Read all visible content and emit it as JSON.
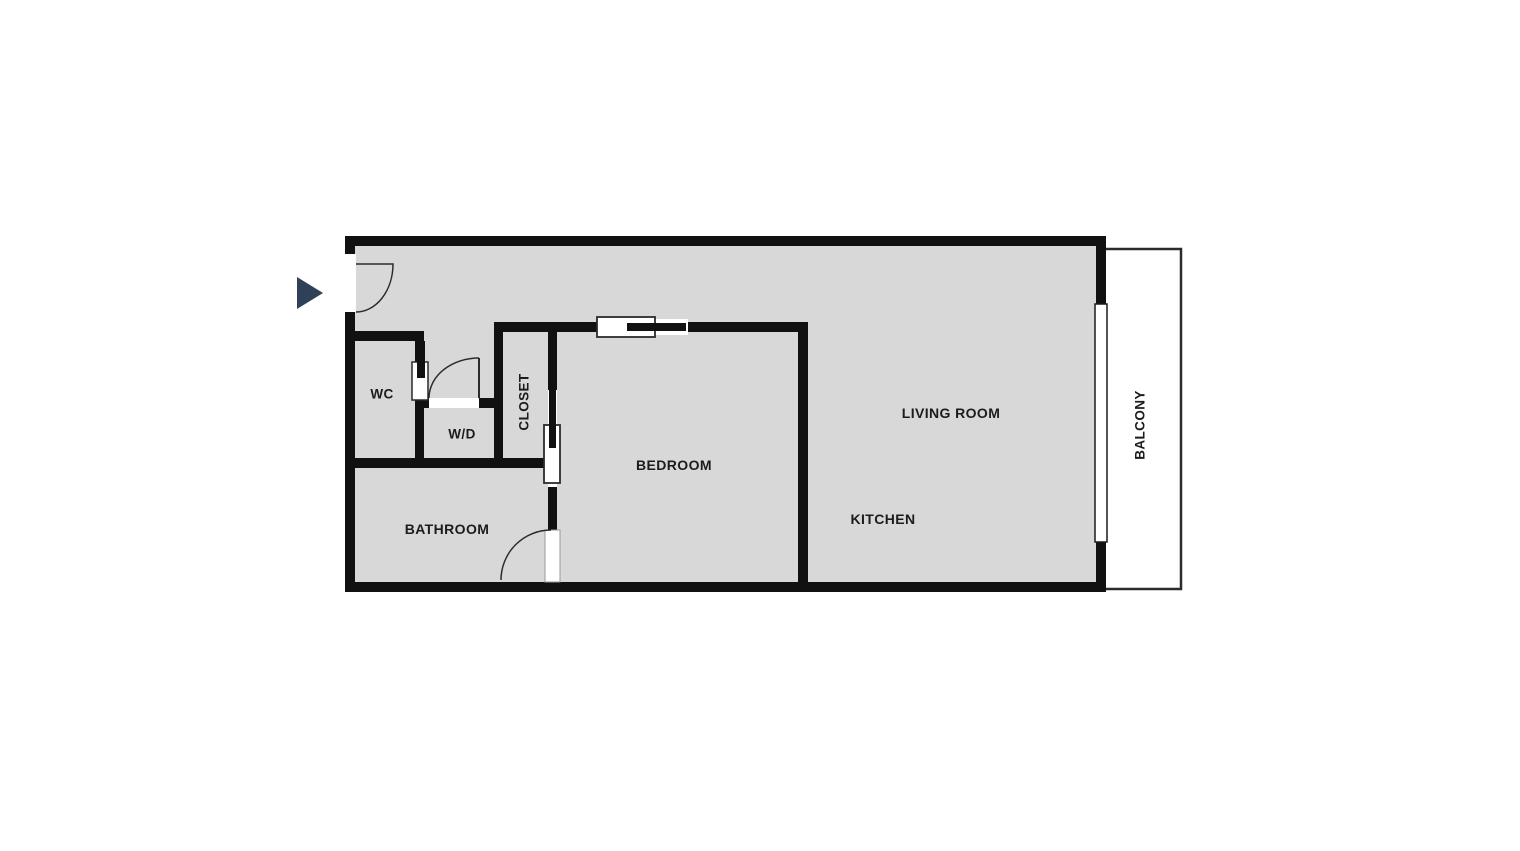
{
  "floorplan": {
    "rooms": {
      "wc": "WC",
      "wd": "W/D",
      "closet": "CLOSET",
      "bathroom": "BATHROOM",
      "bedroom": "BEDROOM",
      "living_room": "LIVING ROOM",
      "kitchen": "KITCHEN",
      "balcony": "BALCONY"
    },
    "icons": {
      "entry_arrow": "right-pointing-triangle"
    },
    "colors": {
      "background": "#ffffff",
      "floor": "#d8d8d8",
      "wall": "#111111",
      "door_outline": "#2b2b2b",
      "entry_arrow": "#2e4158",
      "label_text": "#1c1c1c"
    }
  }
}
